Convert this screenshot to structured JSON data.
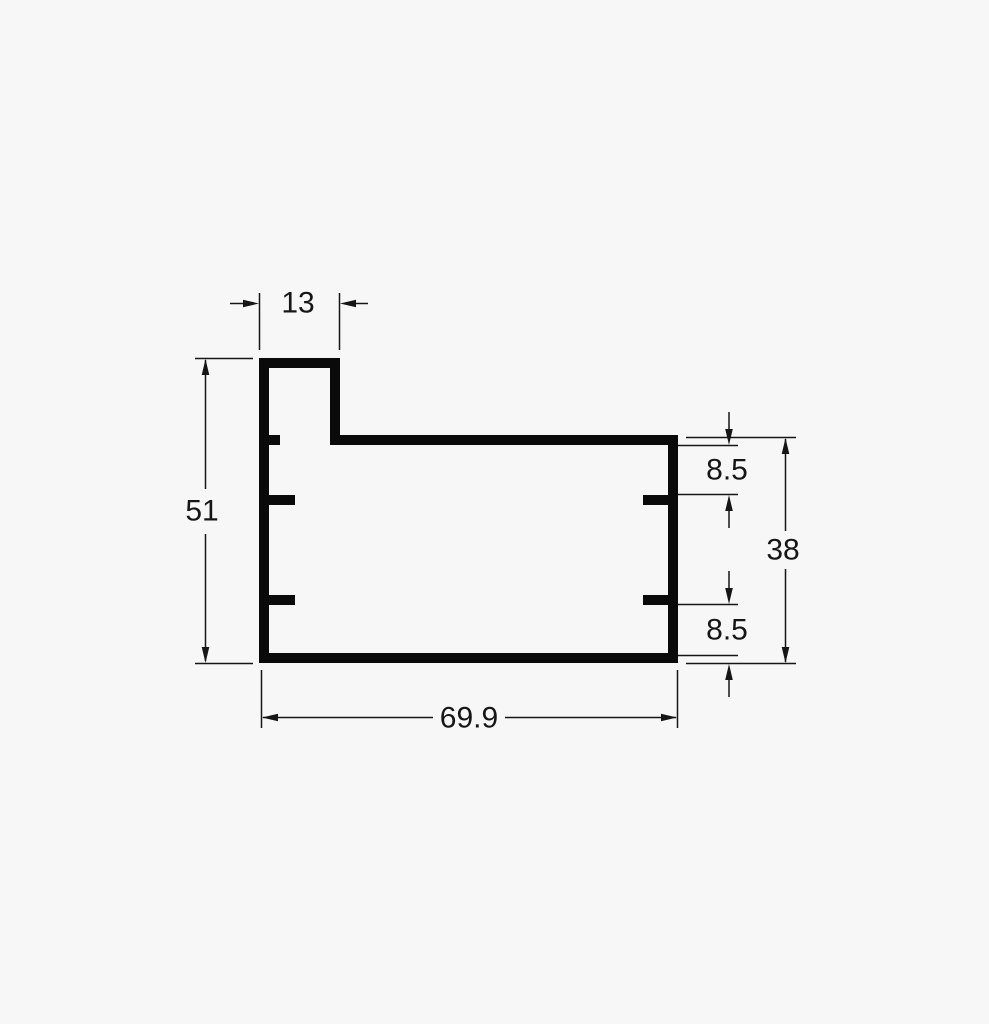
{
  "drawing": {
    "kind": "technical-drawing-profile-cross-section",
    "background_color": "#f7f7f7",
    "line_color": "#161616",
    "profile_color": "#0a0a0a",
    "dimensions": {
      "tab_width": {
        "label": "13",
        "orientation": "horizontal",
        "location": "top"
      },
      "overall_height": {
        "label": "51",
        "orientation": "vertical",
        "location": "left"
      },
      "overall_width": {
        "label": "69.9",
        "orientation": "horizontal",
        "location": "bottom"
      },
      "right_height": {
        "label": "38",
        "orientation": "vertical",
        "location": "right-outer"
      },
      "upper_offset": {
        "label": "8.5",
        "orientation": "vertical",
        "location": "right-upper"
      },
      "lower_offset": {
        "label": "8.5",
        "orientation": "vertical",
        "location": "right-lower"
      }
    }
  }
}
